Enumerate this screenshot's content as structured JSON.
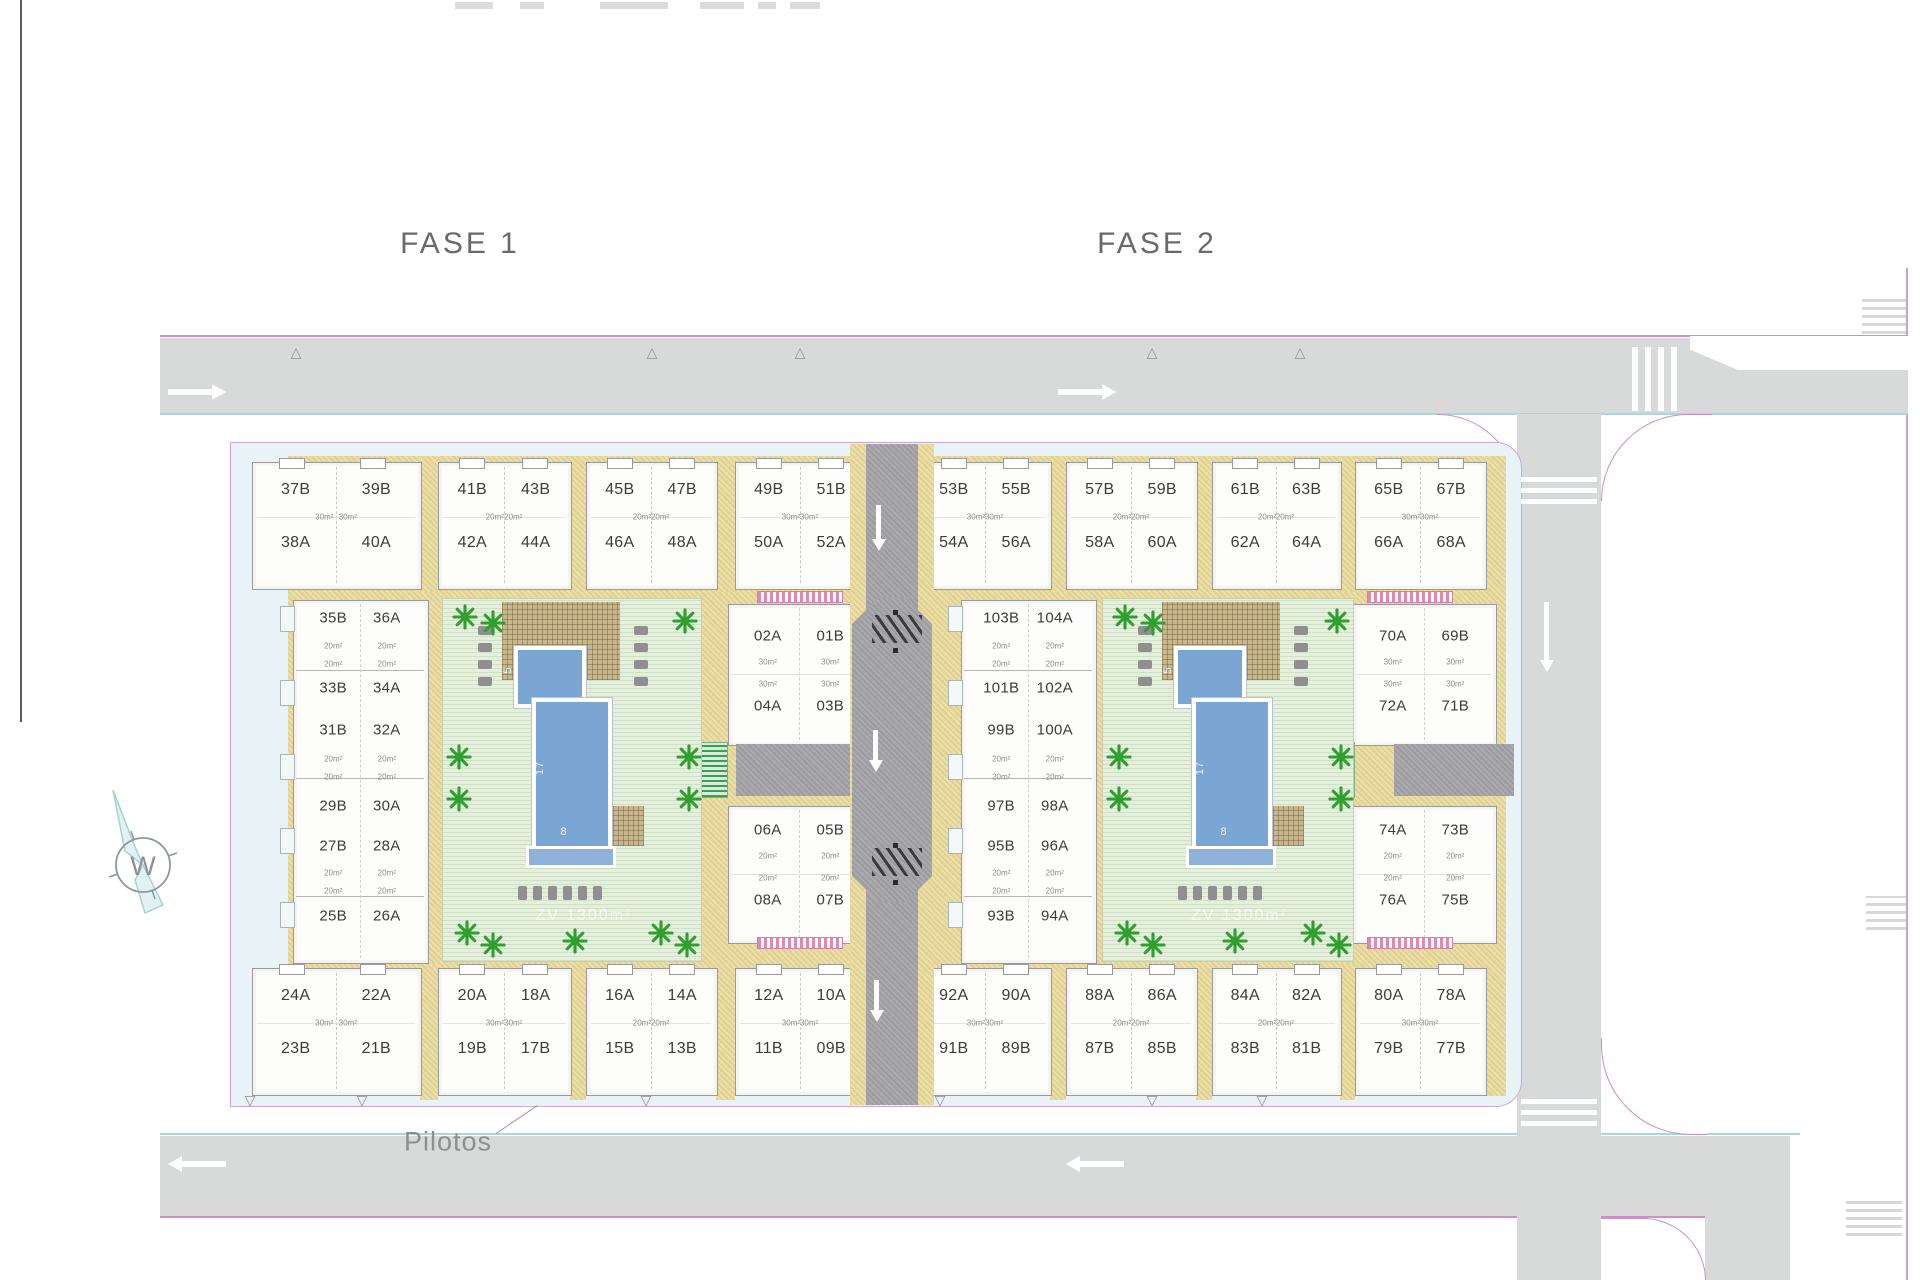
{
  "titles": {
    "fase1": "FASE 1",
    "fase2": "FASE 2"
  },
  "annotations": {
    "pilotos": "Pilotos",
    "compass_letter": "W",
    "courtyard_watermark": "ZV 1300m²"
  },
  "icons": {
    "entrance_up": "△",
    "entrance_down": "▽"
  },
  "pool_dimensions": {
    "length": "17",
    "width": "8",
    "head": "5"
  },
  "phase1": {
    "top_quads": [
      {
        "units": [
          "37B",
          "39B",
          "38A",
          "40A"
        ],
        "area": "30m²"
      },
      {
        "units": [
          "41B",
          "43B",
          "42A",
          "44A"
        ],
        "area": "20m²"
      },
      {
        "units": [
          "45B",
          "47B",
          "46A",
          "48A"
        ],
        "area": "20m²"
      },
      {
        "units": [
          "49B",
          "51B",
          "50A",
          "52A"
        ],
        "area": "30m²"
      }
    ],
    "bottom_quads": [
      {
        "units": [
          "24A",
          "22A",
          "23B",
          "21B"
        ],
        "area": "30m²"
      },
      {
        "units": [
          "20A",
          "18A",
          "19B",
          "17B"
        ],
        "area": "30m²"
      },
      {
        "units": [
          "16A",
          "14A",
          "15B",
          "13B"
        ],
        "area": "20m²"
      },
      {
        "units": [
          "12A",
          "10A",
          "11B",
          "09B"
        ],
        "area": "30m²"
      }
    ],
    "left_column_rows": [
      [
        "35B",
        "36A"
      ],
      [
        "33B",
        "34A"
      ],
      [
        "31B",
        "32A"
      ],
      [
        "29B",
        "30A"
      ],
      [
        "27B",
        "28A"
      ],
      [
        "25B",
        "26A"
      ]
    ],
    "left_column_area": "20m²",
    "mid_column_rows": [
      [
        "02A",
        "01B"
      ],
      [
        "04A",
        "03B"
      ],
      [
        "06A",
        "05B"
      ],
      [
        "08A",
        "07B"
      ]
    ],
    "mid_column_area_top": "30m²",
    "mid_column_area_bottom": "20m²"
  },
  "phase2": {
    "top_quads": [
      {
        "units": [
          "53B",
          "55B",
          "54A",
          "56A"
        ],
        "area": "30m²"
      },
      {
        "units": [
          "57B",
          "59B",
          "58A",
          "60A"
        ],
        "area": "20m²"
      },
      {
        "units": [
          "61B",
          "63B",
          "62A",
          "64A"
        ],
        "area": "20m²"
      },
      {
        "units": [
          "65B",
          "67B",
          "66A",
          "68A"
        ],
        "area": "30m²"
      }
    ],
    "bottom_quads": [
      {
        "units": [
          "92A",
          "90A",
          "91B",
          "89B"
        ],
        "area": "30m²"
      },
      {
        "units": [
          "88A",
          "86A",
          "87B",
          "85B"
        ],
        "area": "20m²"
      },
      {
        "units": [
          "84A",
          "82A",
          "83B",
          "81B"
        ],
        "area": "20m²"
      },
      {
        "units": [
          "80A",
          "78A",
          "79B",
          "77B"
        ],
        "area": "30m²"
      }
    ],
    "left_column_rows": [
      [
        "103B",
        "104A"
      ],
      [
        "101B",
        "102A"
      ],
      [
        "99B",
        "100A"
      ],
      [
        "97B",
        "98A"
      ],
      [
        "95B",
        "96A"
      ],
      [
        "93B",
        "94A"
      ]
    ],
    "left_column_area": "20m²",
    "right_column_rows": [
      [
        "70A",
        "69B"
      ],
      [
        "72A",
        "71B"
      ],
      [
        "74A",
        "73B"
      ],
      [
        "76A",
        "75B"
      ]
    ],
    "right_column_area_top": "30m²",
    "right_column_area_bottom": "20m²"
  },
  "colors": {
    "road": "#d8dad9",
    "walk": "#a9a9ae",
    "plot": "#e9f3f7",
    "tan": "#ecdfa7",
    "lawn": "#e6efde",
    "pool": "#7ba6d4",
    "palm": "#2fa02f",
    "perg": "#c8b68c",
    "pink": "#cc8fcb",
    "cyan": "#a8d8da",
    "label": "#3c3c3c",
    "title": "#6a6a6a"
  }
}
